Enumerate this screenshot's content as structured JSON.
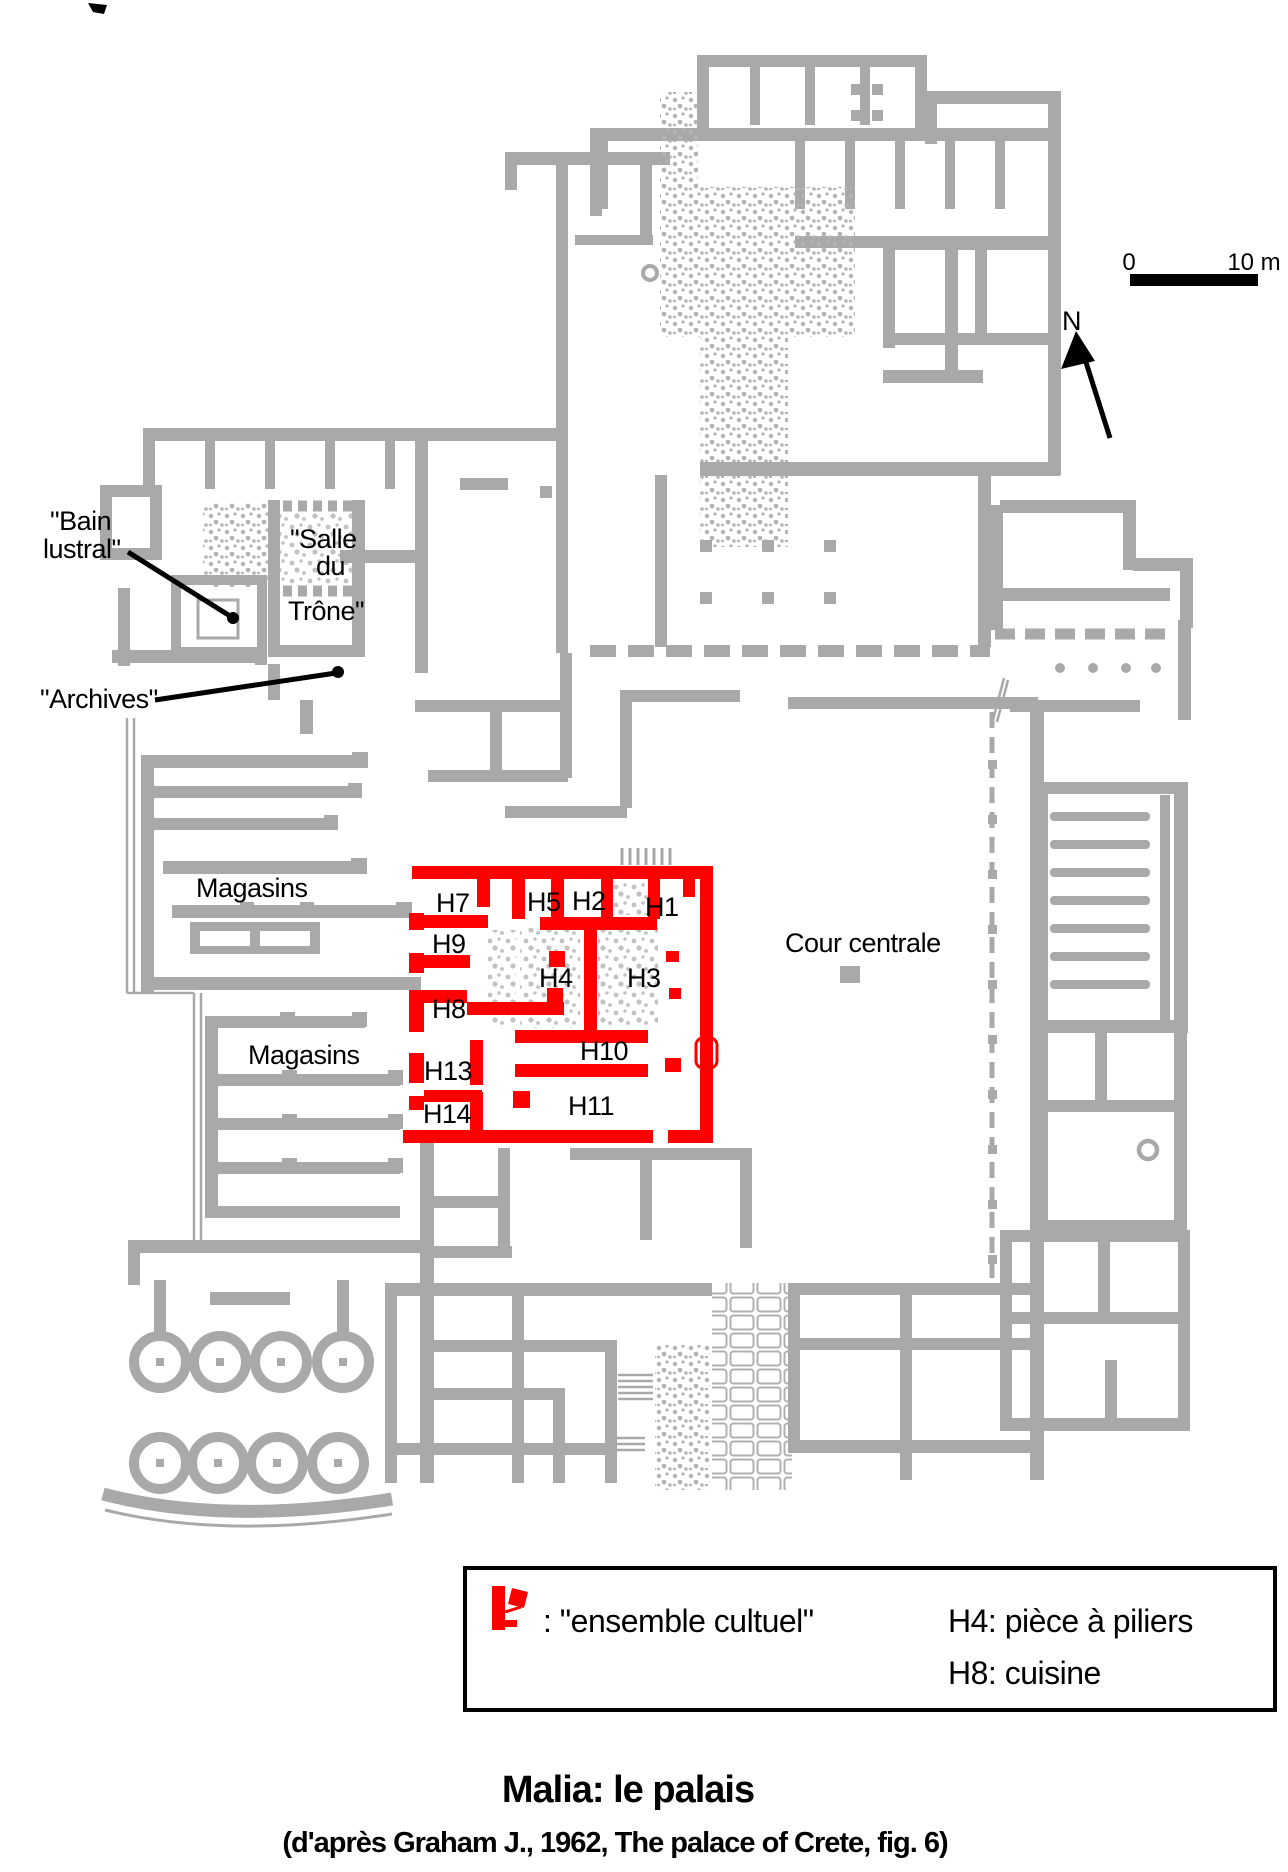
{
  "colors": {
    "wall": "#a9a9a9",
    "highlight": "#ff0000",
    "text": "#000000",
    "background": "#ffffff"
  },
  "scale_bar": {
    "start_label": "0",
    "end_label": "10 m"
  },
  "compass": {
    "label": "N"
  },
  "icons": {
    "north_arrow": "arrow-up",
    "legend_marker": "red-plan-fragment"
  },
  "plan_annotations": {
    "bain_lustral_line1": "\"Bain",
    "bain_lustral_line2": "lustral\"",
    "salle_line1": "\"Salle",
    "salle_line2": "du",
    "salle_line3": "Trône\"",
    "archives": "\"Archives\"",
    "magasins_upper": "Magasins",
    "magasins_lower": "Magasins",
    "cour_centrale": "Cour centrale"
  },
  "rooms": {
    "h1": "H1",
    "h2": "H2",
    "h3": "H3",
    "h4": "H4",
    "h5": "H5",
    "h7": "H7",
    "h8": "H8",
    "h9": "H9",
    "h10": "H10",
    "h11": "H11",
    "h13": "H13",
    "h14": "H14"
  },
  "legend": {
    "ensemble_cultuel": ": \"ensemble cultuel\"",
    "h4_note": "H4: pièce à piliers",
    "h8_note": "H8: cuisine"
  },
  "title": "Malia: le palais",
  "subtitle": "(d'après Graham J., 1962, The palace of Crete, fig. 6)"
}
